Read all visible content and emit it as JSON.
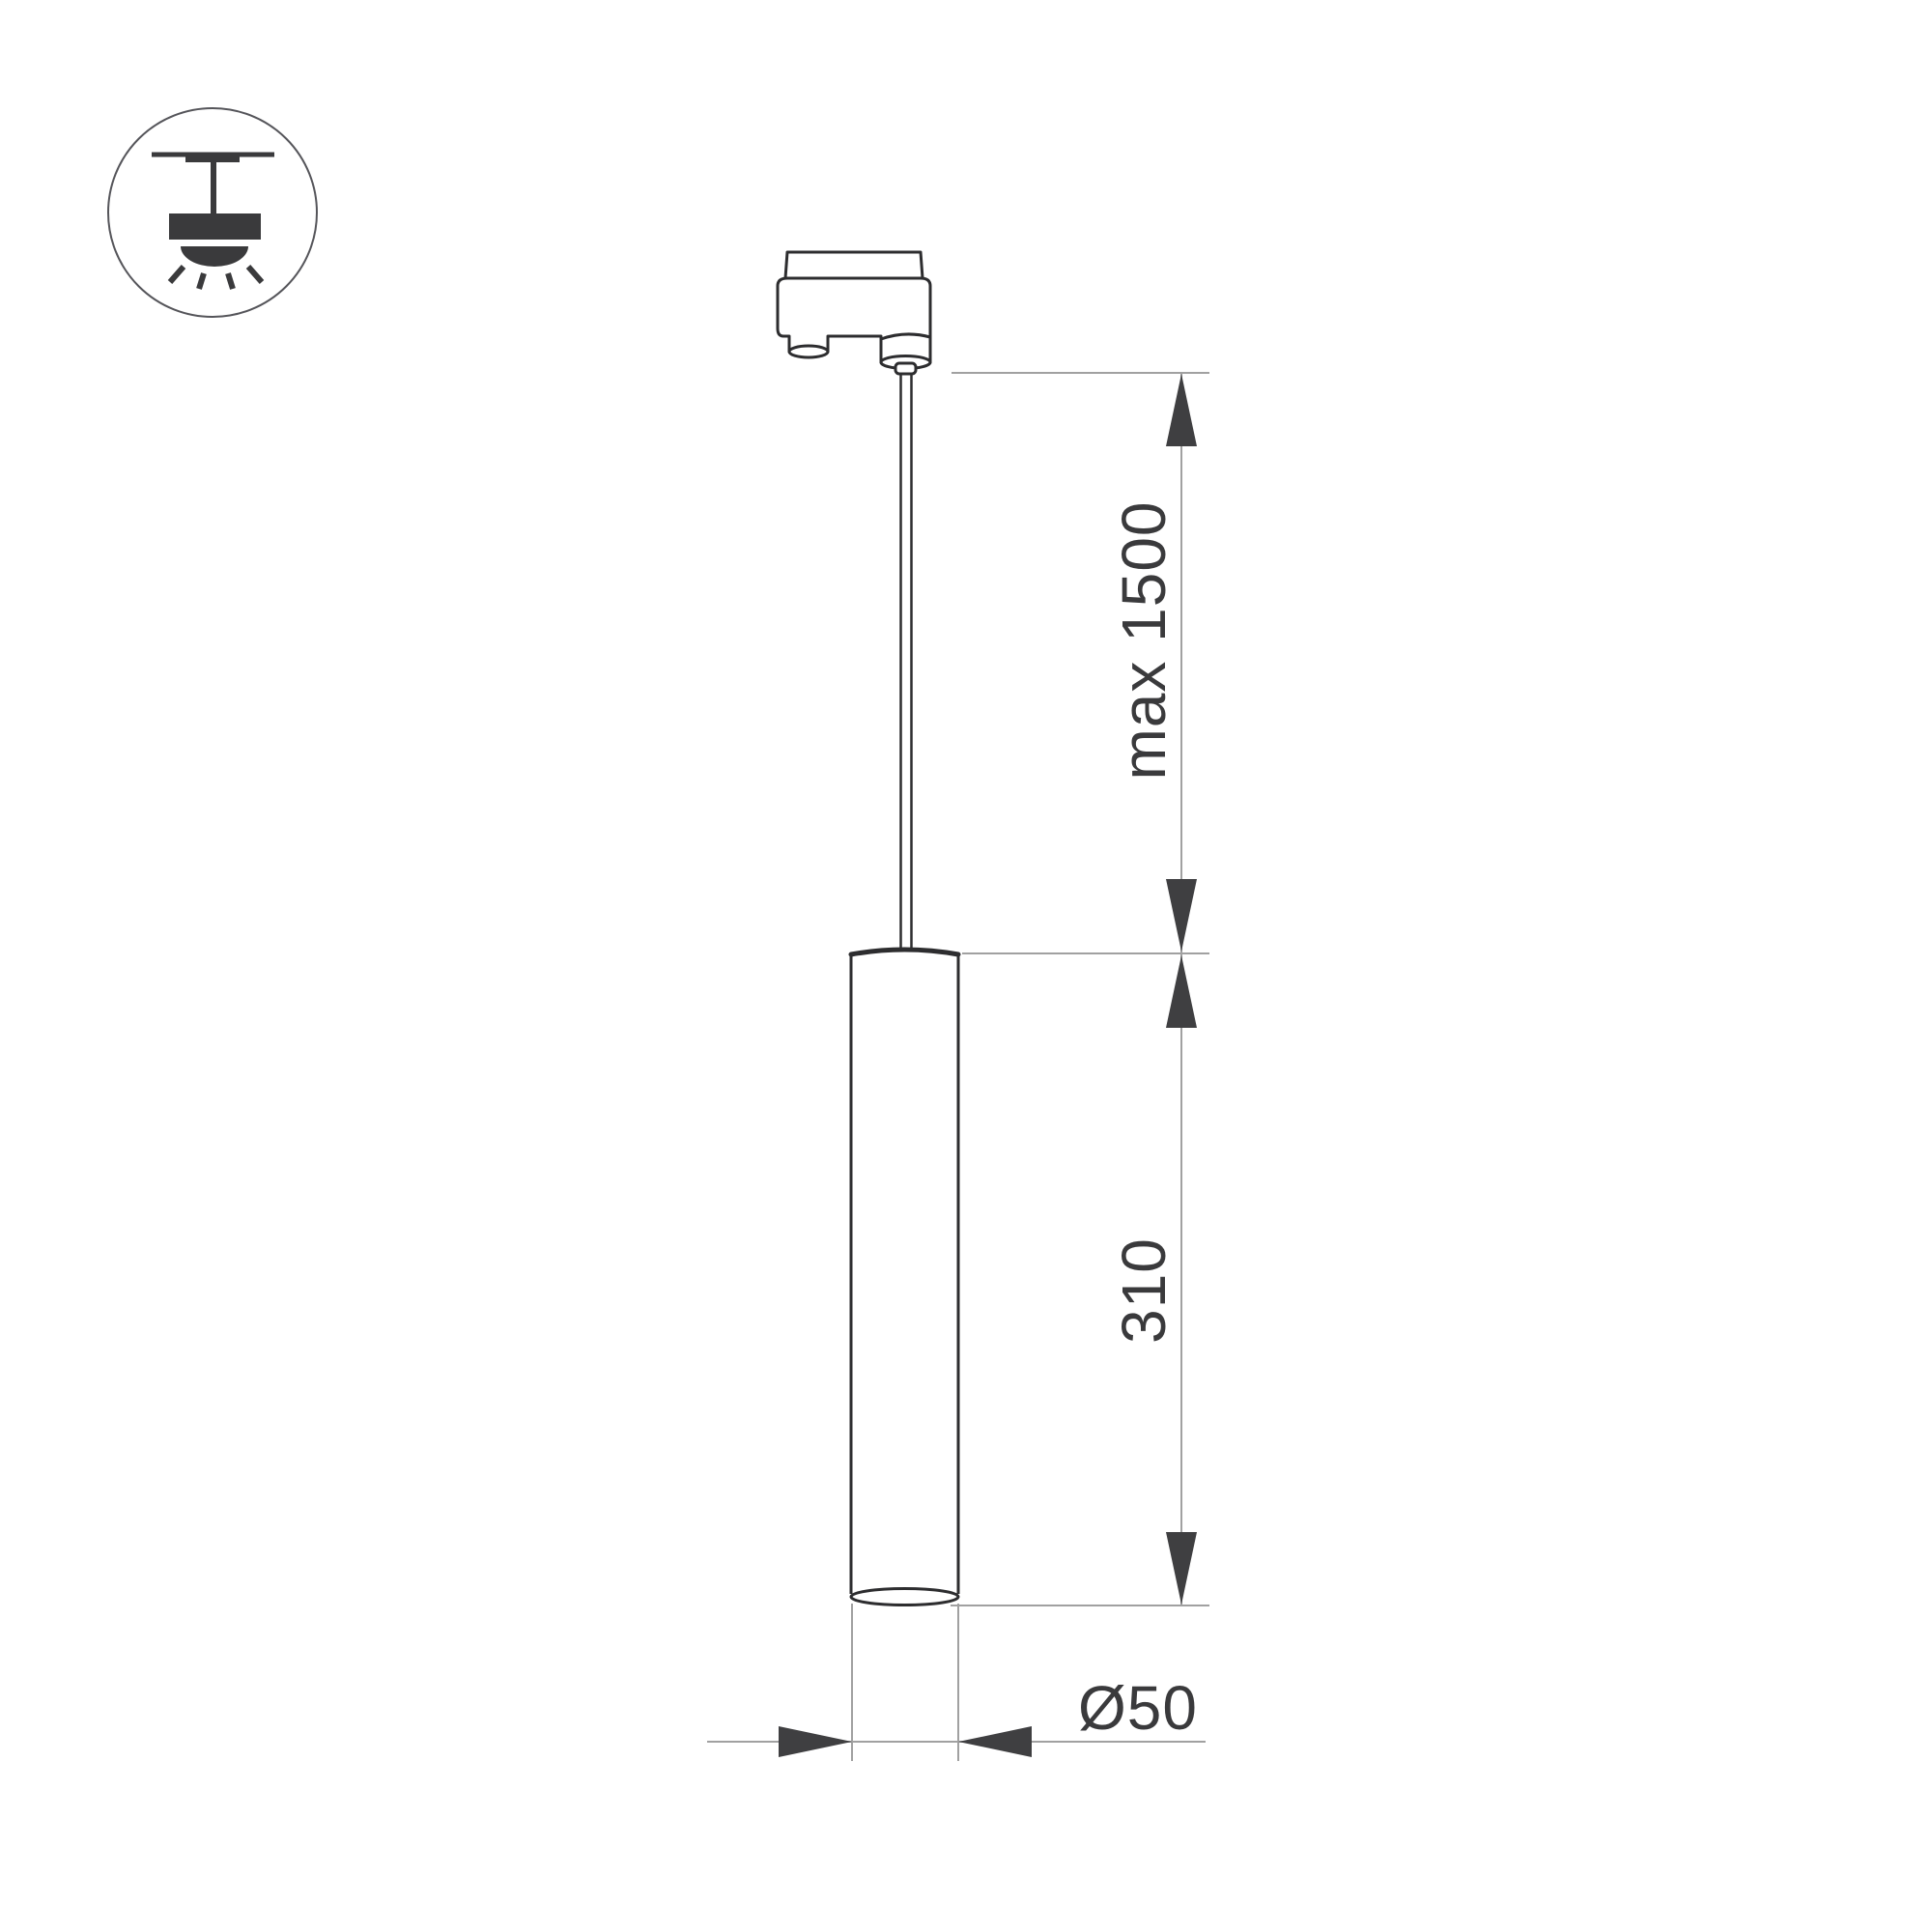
{
  "icon": {
    "name": "ceiling-pendant-mount-icon"
  },
  "dimensions": {
    "suspension_max": "max 1500",
    "body_length": "310",
    "body_diameter": "Ø50"
  },
  "colors": {
    "background": "#ffffff",
    "outline": "#2d2d2f",
    "dim_line": "#a1a1a1",
    "arrow_fill": "#3f3f41",
    "label_text": "#3a3a3c"
  }
}
